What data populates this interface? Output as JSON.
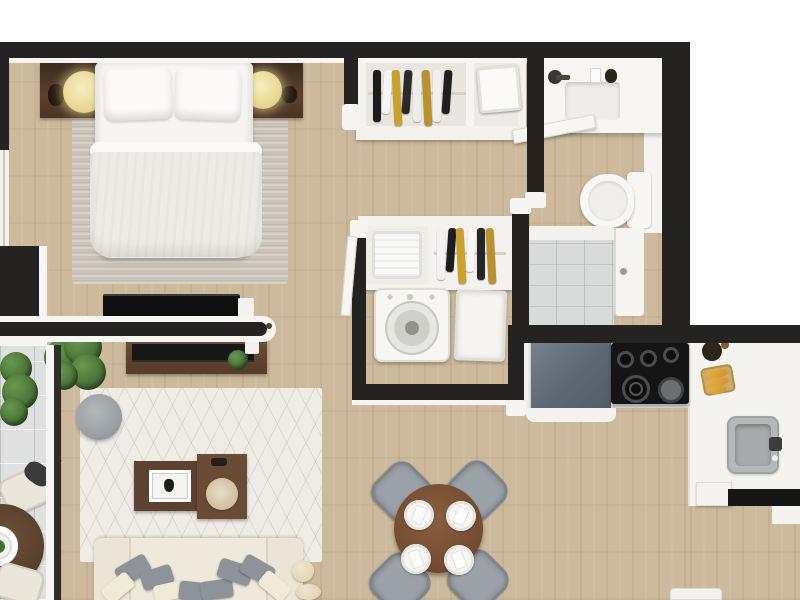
{
  "scene": {
    "type": "3d-floor-plan-render",
    "view": "top-down",
    "description": "Photorealistic top-down 3D rendering of a one-bedroom apartment floor plan with bedroom, closets, bathroom with shower, laundry nook, open living-dining area, kitchen and balcony. No text labels are visible in the image."
  },
  "palette": {
    "wall": "#242321",
    "wall_edge": "#f6f5f2",
    "wood_floor": "#cdb99c",
    "balcony_tile": "#dfe1e0",
    "shower_tile": "#d9dbda",
    "rug_living": "#efece5",
    "rug_bedroom": "#c9c3b8",
    "sofa": "#efe9dc",
    "chair_gray": "#9aa1a7",
    "wood_furniture": "#5c4331",
    "dining_table_brown": "#714a30",
    "fridge_gray_blue": "#5c6773",
    "appliance_black": "#151515",
    "plant_green": "#466f35",
    "lamp_cream": "#e9d795",
    "bread_gold": "#cf8f2b"
  },
  "labels": {
    "plan": "apartment floor plan render",
    "bedroom": "bedroom",
    "bed": "double bed",
    "pillow": "bed pillow",
    "duvet": "duvet",
    "headboard": "headboard console",
    "lamp": "bedside table lamp",
    "bedroom_rug": "bedroom rug",
    "bedroom_tv": "bedroom wall TV",
    "window": "bedroom window",
    "door": "interior door",
    "closet_top": "wardrobe with hanging clothes",
    "clothes_rack": "hanging clothes",
    "storage_box": "storage box",
    "closet_lower": "linen closet",
    "laundry_basket": "laundry basket",
    "washer": "washing machine",
    "hamper": "hamper",
    "bathroom": "bathroom",
    "vanity": "bathroom vanity",
    "basin": "sink basin",
    "faucet": "faucet",
    "toilet": "toilet",
    "shower": "walk-in shower",
    "shower_door": "shower door",
    "living_room": "living room",
    "living_rug": "living room area rug",
    "media_console": "media console",
    "living_tv": "living room TV",
    "pouf": "round pouf",
    "coffee_table": "coffee table",
    "picture_frame": "picture frame",
    "sofa": "sofa",
    "throw_pillow": "throw pillow",
    "ottoman": "ottoman",
    "plant": "potted plant",
    "balcony": "balcony",
    "balcony_table": "balcony bistro table",
    "balcony_chair": "balcony chair",
    "dining_area": "dining area",
    "dining_table": "round dining table",
    "dining_chair": "dining chair",
    "place_setting": "place setting",
    "kitchen": "kitchen",
    "fridge": "refrigerator",
    "cooktop": "cooktop with burners",
    "counter": "kitchen counter",
    "kitchen_sink": "kitchen sink",
    "bread_board": "bread on cutting board",
    "wall": "wall"
  },
  "rooms": {
    "bedroom": {
      "label": "Bedroom",
      "items": [
        "double bed",
        "two pillows",
        "duvet",
        "headboard console",
        "two table lamps",
        "rug",
        "wall TV",
        "window"
      ]
    },
    "closets": {
      "label": "Closets",
      "items": [
        "wardrobe with hanging clothes",
        "storage box",
        "linen closet",
        "laundry basket"
      ]
    },
    "laundry": {
      "label": "Laundry nook",
      "items": [
        "washing machine",
        "hamper"
      ]
    },
    "bathroom": {
      "label": "Bathroom",
      "items": [
        "vanity with basin",
        "faucet",
        "toilet",
        "walk-in shower",
        "shower door",
        "open door"
      ]
    },
    "living": {
      "label": "Living room",
      "items": [
        "sofa with throw pillows",
        "area rug",
        "round pouf",
        "two coffee tables",
        "picture frame",
        "media console",
        "potted plants",
        "ottomans"
      ]
    },
    "dining": {
      "label": "Dining area",
      "items": [
        "round table",
        "four gray chairs",
        "four place settings"
      ]
    },
    "kitchen": {
      "label": "Kitchen",
      "items": [
        "refrigerator",
        "cooktop with five burners",
        "L-shaped counter",
        "sink",
        "bread board",
        "plant pot"
      ]
    },
    "balcony": {
      "label": "Balcony",
      "items": [
        "bistro table",
        "two chairs",
        "plants",
        "tiled floor"
      ]
    }
  },
  "closet_racks": {
    "top_rack_colors": [
      "#1b1b1b",
      "#f5f5f5",
      "#c9a12b",
      "#2a2a2a",
      "#ededec",
      "#b8932b",
      "#f0efee",
      "#1f1f1f"
    ],
    "lower_rack_colors": [
      "#f2f1ef",
      "#1d1d1d",
      "#c9a12b",
      "#f6f6f5",
      "#262626",
      "#b8932b"
    ]
  }
}
